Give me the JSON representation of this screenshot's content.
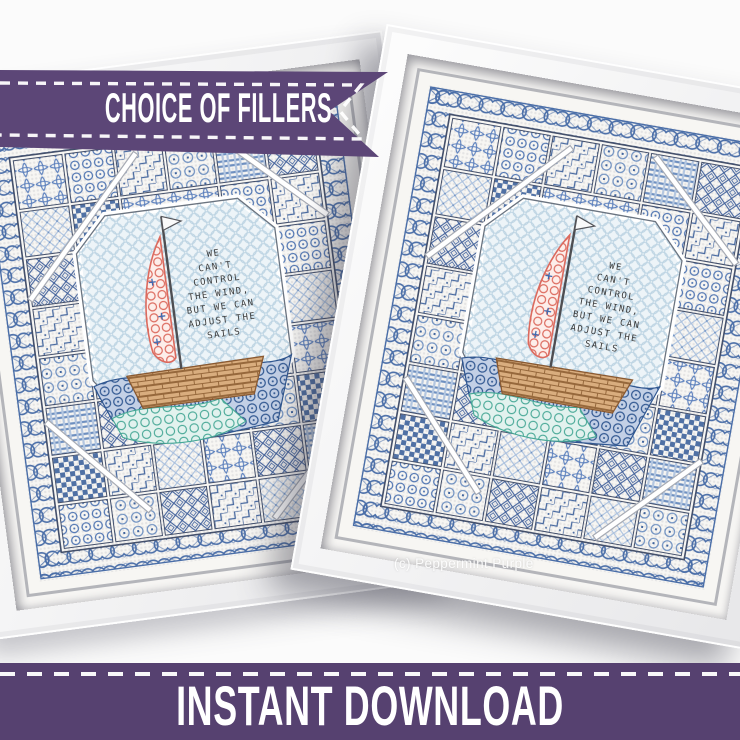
{
  "page": {
    "background_color": "#fbfbfb"
  },
  "top_banner": {
    "label": "CHOICE OF FILLERS",
    "fill_color": "#5c4677",
    "stitch_color": "#ffffff"
  },
  "bottom_banner": {
    "label": "INSTANT DOWNLOAD",
    "fill_color": "#564170",
    "stitch_color": "#ffffff"
  },
  "watermark": {
    "label": "(c) Peppermint Purple"
  },
  "artwork": {
    "quote_lines": [
      "WE",
      "CAN'T",
      "CONTROL",
      "THE WIND,",
      "BUT WE CAN",
      "ADJUST THE",
      "SAILS"
    ],
    "palette": {
      "thread_blue": "#4a6ea8",
      "thread_blue_mid": "#6d8fc0",
      "thread_blue_dark": "#3e639d",
      "thread_blue_light": "#a9c0de",
      "patch_outline": "#44506b",
      "center_background": "#edf4f8",
      "honeycomb": "#b7d0e0",
      "sail_red": "#dc6a5e",
      "hull_brown": "#96683c",
      "wave_navy": "#2f5690",
      "wave_teal": "#45a795",
      "quote_text": "#3b3b3b",
      "flag_white": "#fafafa"
    }
  }
}
